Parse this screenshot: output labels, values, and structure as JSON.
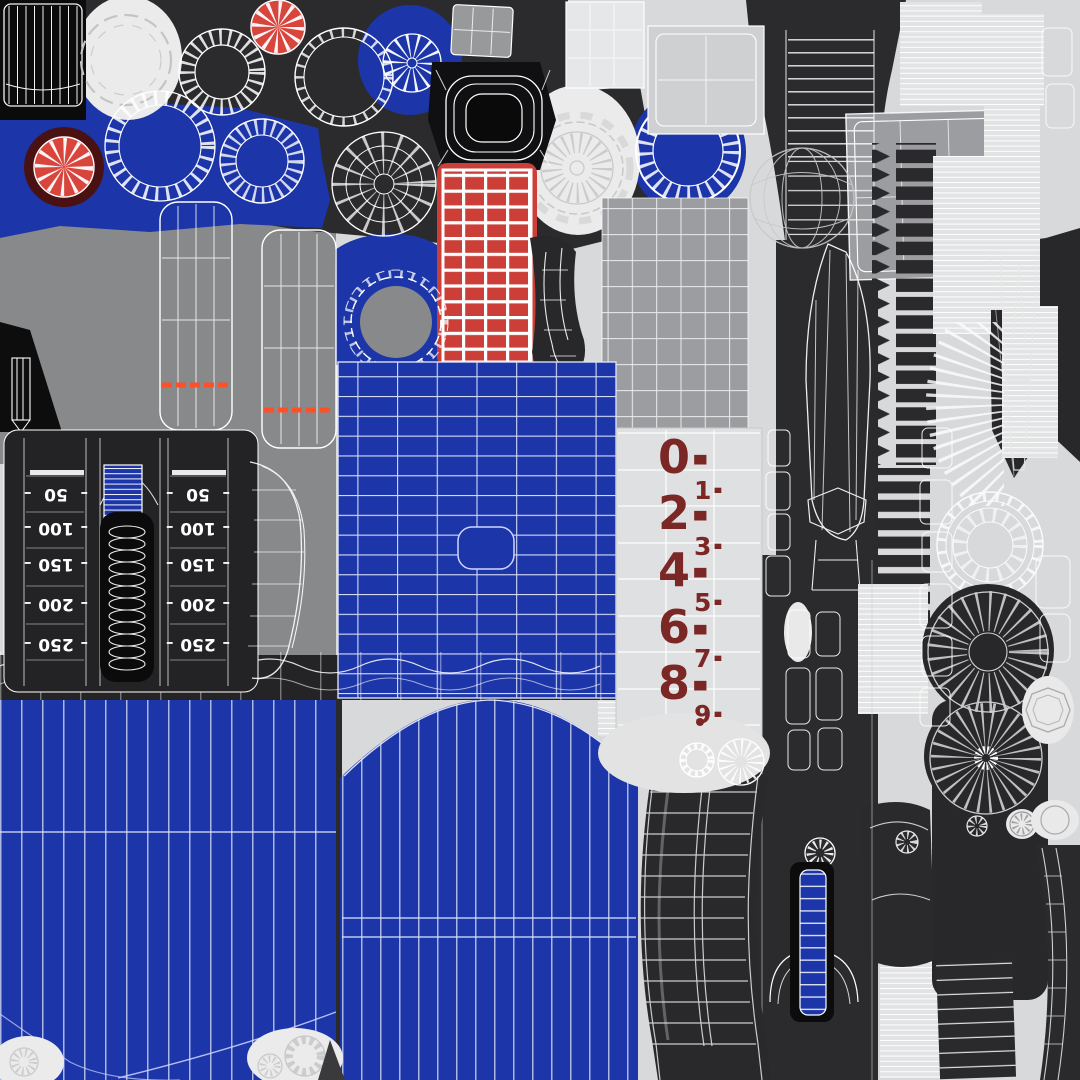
{
  "colors": {
    "blue": "#1c35a8",
    "charcoal": "#2b2b2d",
    "near_black": "#0b0b0b",
    "mid_gray": "#88898b",
    "panel_gray": "#9b9da0",
    "light_gray": "#d8d9da",
    "white_blob": "#ebebeb",
    "red": "#cc3e38",
    "red_wheel": "#d8453c",
    "dark_red": "#4a1112",
    "maroon_digits": "#7b2725",
    "orange_stripe": "#ff4f26",
    "wire": "#ffffff"
  },
  "range_scale": {
    "tick": "–",
    "left_column": [
      "50",
      "100",
      "150",
      "200",
      "250"
    ],
    "right_column": [
      "50",
      "100",
      "150",
      "200",
      "250"
    ]
  },
  "shot_counter": {
    "dash": "-",
    "digits": [
      "0",
      "1",
      "2",
      "3",
      "4",
      "5",
      "6",
      "7",
      "8",
      "9"
    ]
  }
}
